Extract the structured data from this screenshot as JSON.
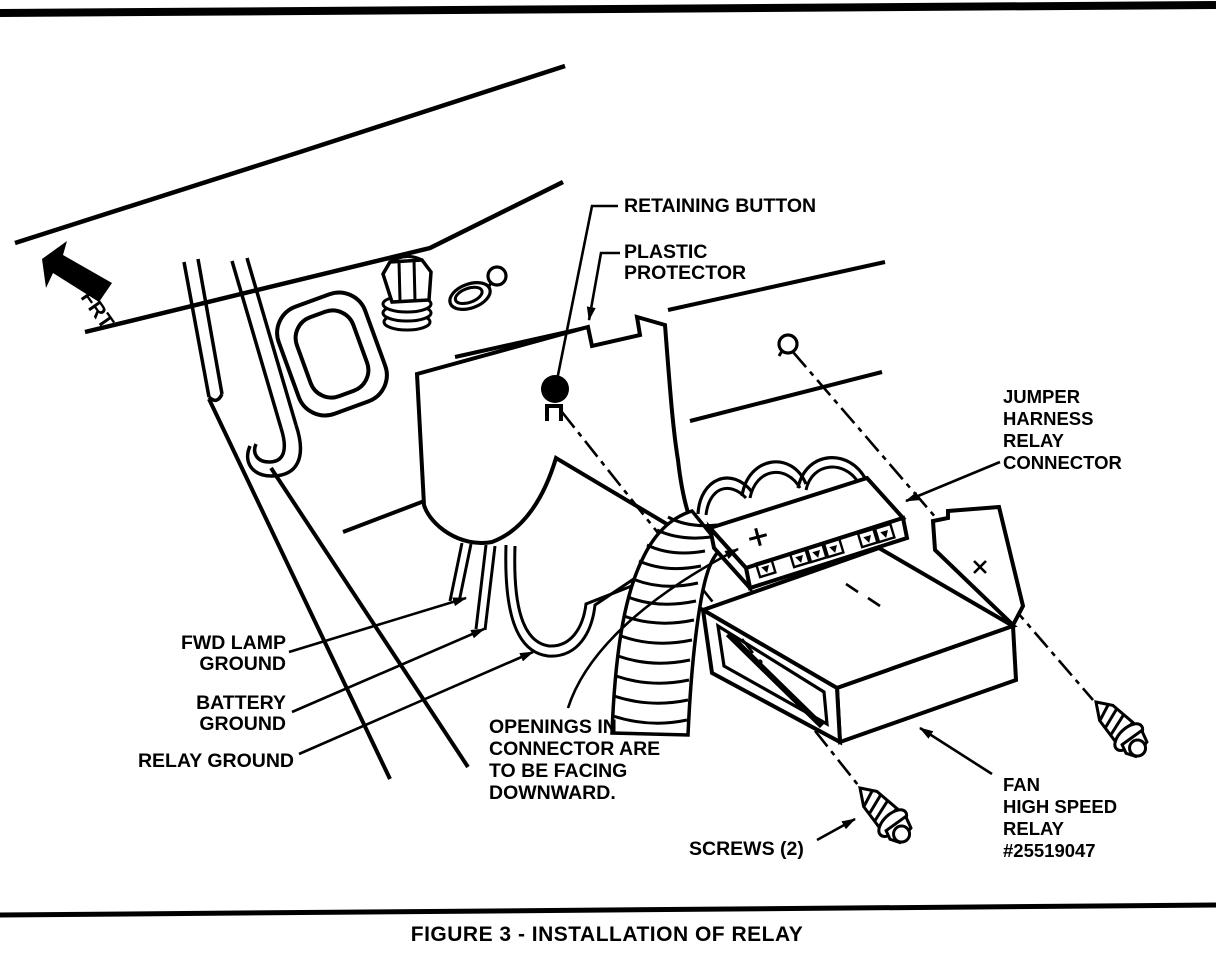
{
  "figure": {
    "caption": "FIGURE 3 - INSTALLATION OF RELAY",
    "orientation_marker": "FRT"
  },
  "labels": {
    "retaining_button": "RETAINING BUTTON",
    "plastic_protector": [
      "PLASTIC",
      "PROTECTOR"
    ],
    "jumper_harness": [
      "JUMPER",
      "HARNESS",
      "RELAY",
      "CONNECTOR"
    ],
    "fwd_lamp_ground": [
      "FWD LAMP",
      "GROUND"
    ],
    "battery_ground": [
      "BATTERY",
      "GROUND"
    ],
    "relay_ground": "RELAY GROUND",
    "openings_note": [
      "OPENINGS IN",
      "CONNECTOR ARE",
      "TO BE FACING",
      "DOWNWARD."
    ],
    "screws": "SCREWS (2)",
    "fan_relay": [
      "FAN",
      "HIGH SPEED",
      "RELAY",
      "#25519047"
    ]
  },
  "colors": {
    "ink": "#000000",
    "paper": "#ffffff"
  }
}
